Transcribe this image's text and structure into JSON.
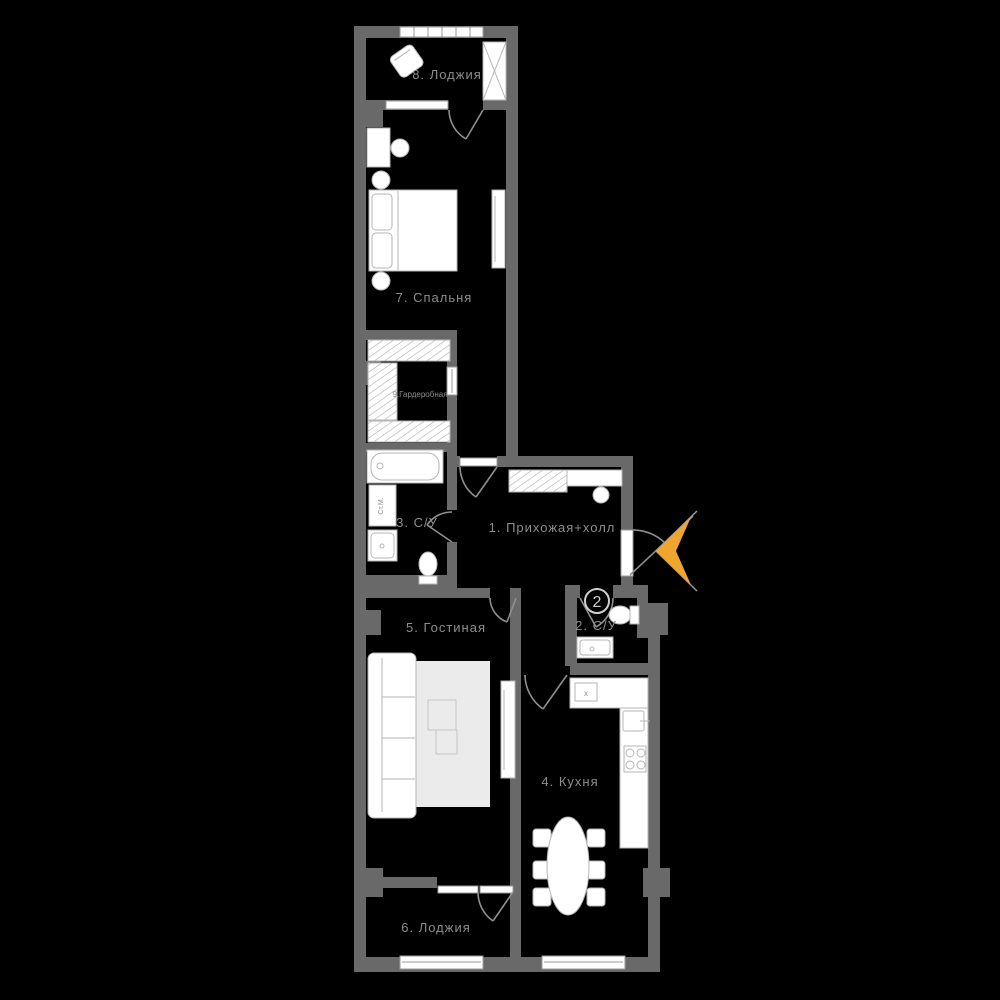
{
  "title": "apartment-floor-plan",
  "colors": {
    "bg": "#000000",
    "wall": "#696969",
    "floor": "#000000",
    "furniture": "#ffffff",
    "furniture_stroke": "#b5b5b5",
    "label": "#8d8d8d",
    "door_arc": "#8f8f8f",
    "accent_arrow": "#f0a62c"
  },
  "rooms": [
    {
      "id": "hallway",
      "label": "1. Прихожая+холл"
    },
    {
      "id": "bathroom-2",
      "label": "2. С/У"
    },
    {
      "id": "bathroom-3",
      "label": "3. С/У"
    },
    {
      "id": "kitchen",
      "label": "4. Кухня"
    },
    {
      "id": "living",
      "label": "5. Гостиная"
    },
    {
      "id": "loggia-6",
      "label": "6. Лоджия"
    },
    {
      "id": "bedroom",
      "label": "7. Спальня"
    },
    {
      "id": "loggia-8",
      "label": "8. Лоджия"
    },
    {
      "id": "wardrobe",
      "label": "9.Гардеробная"
    }
  ],
  "annotations": {
    "entrance_badge": "2",
    "washing_machine": "Ст.М.",
    "counter_mark": "x"
  }
}
